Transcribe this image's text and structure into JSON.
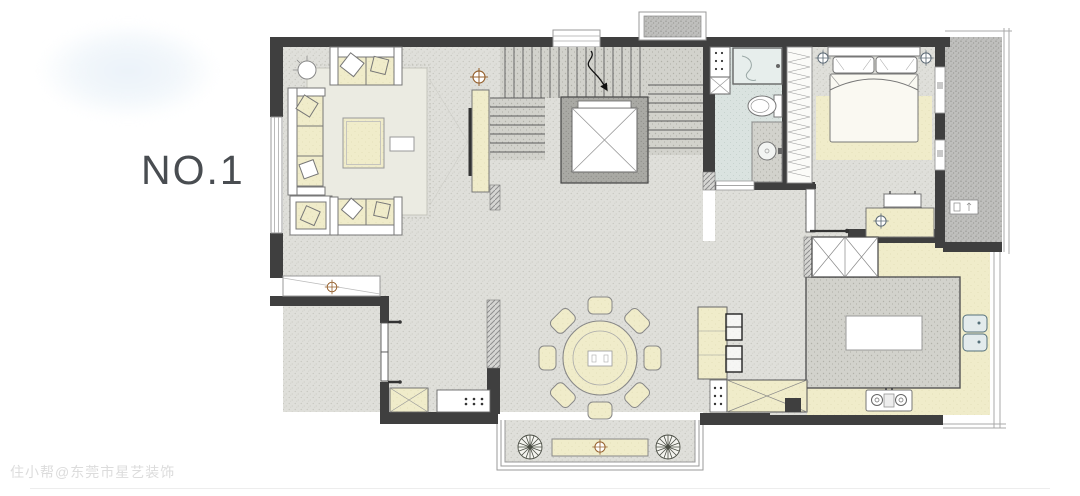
{
  "labels": {
    "plan_number": "NO.1",
    "watermark": "住小帮@东莞市星艺装饰"
  },
  "colors": {
    "wall": "#3f3f3f",
    "floor_base": "#dfdfda",
    "floor_dot": "#c3c3bb",
    "furniture_cream": "#f0ecca",
    "bathroom_floor": "#dae3e0",
    "balcony_floor": "#bfbfbd",
    "rug": "#ebebe2",
    "outline": "#777777",
    "accent_brown": "#96622f",
    "accent_slate": "#5e6b76",
    "label_text": "#494d51",
    "watermark_text": "#dcdcdc",
    "blob_tint": "#ebf2f9"
  },
  "floorplan": {
    "rooms": [
      "living-room",
      "staircase",
      "hallway",
      "bathroom",
      "wardrobe",
      "master-bedroom",
      "balcony",
      "kitchen",
      "dining-room",
      "entry",
      "bay-window"
    ]
  }
}
